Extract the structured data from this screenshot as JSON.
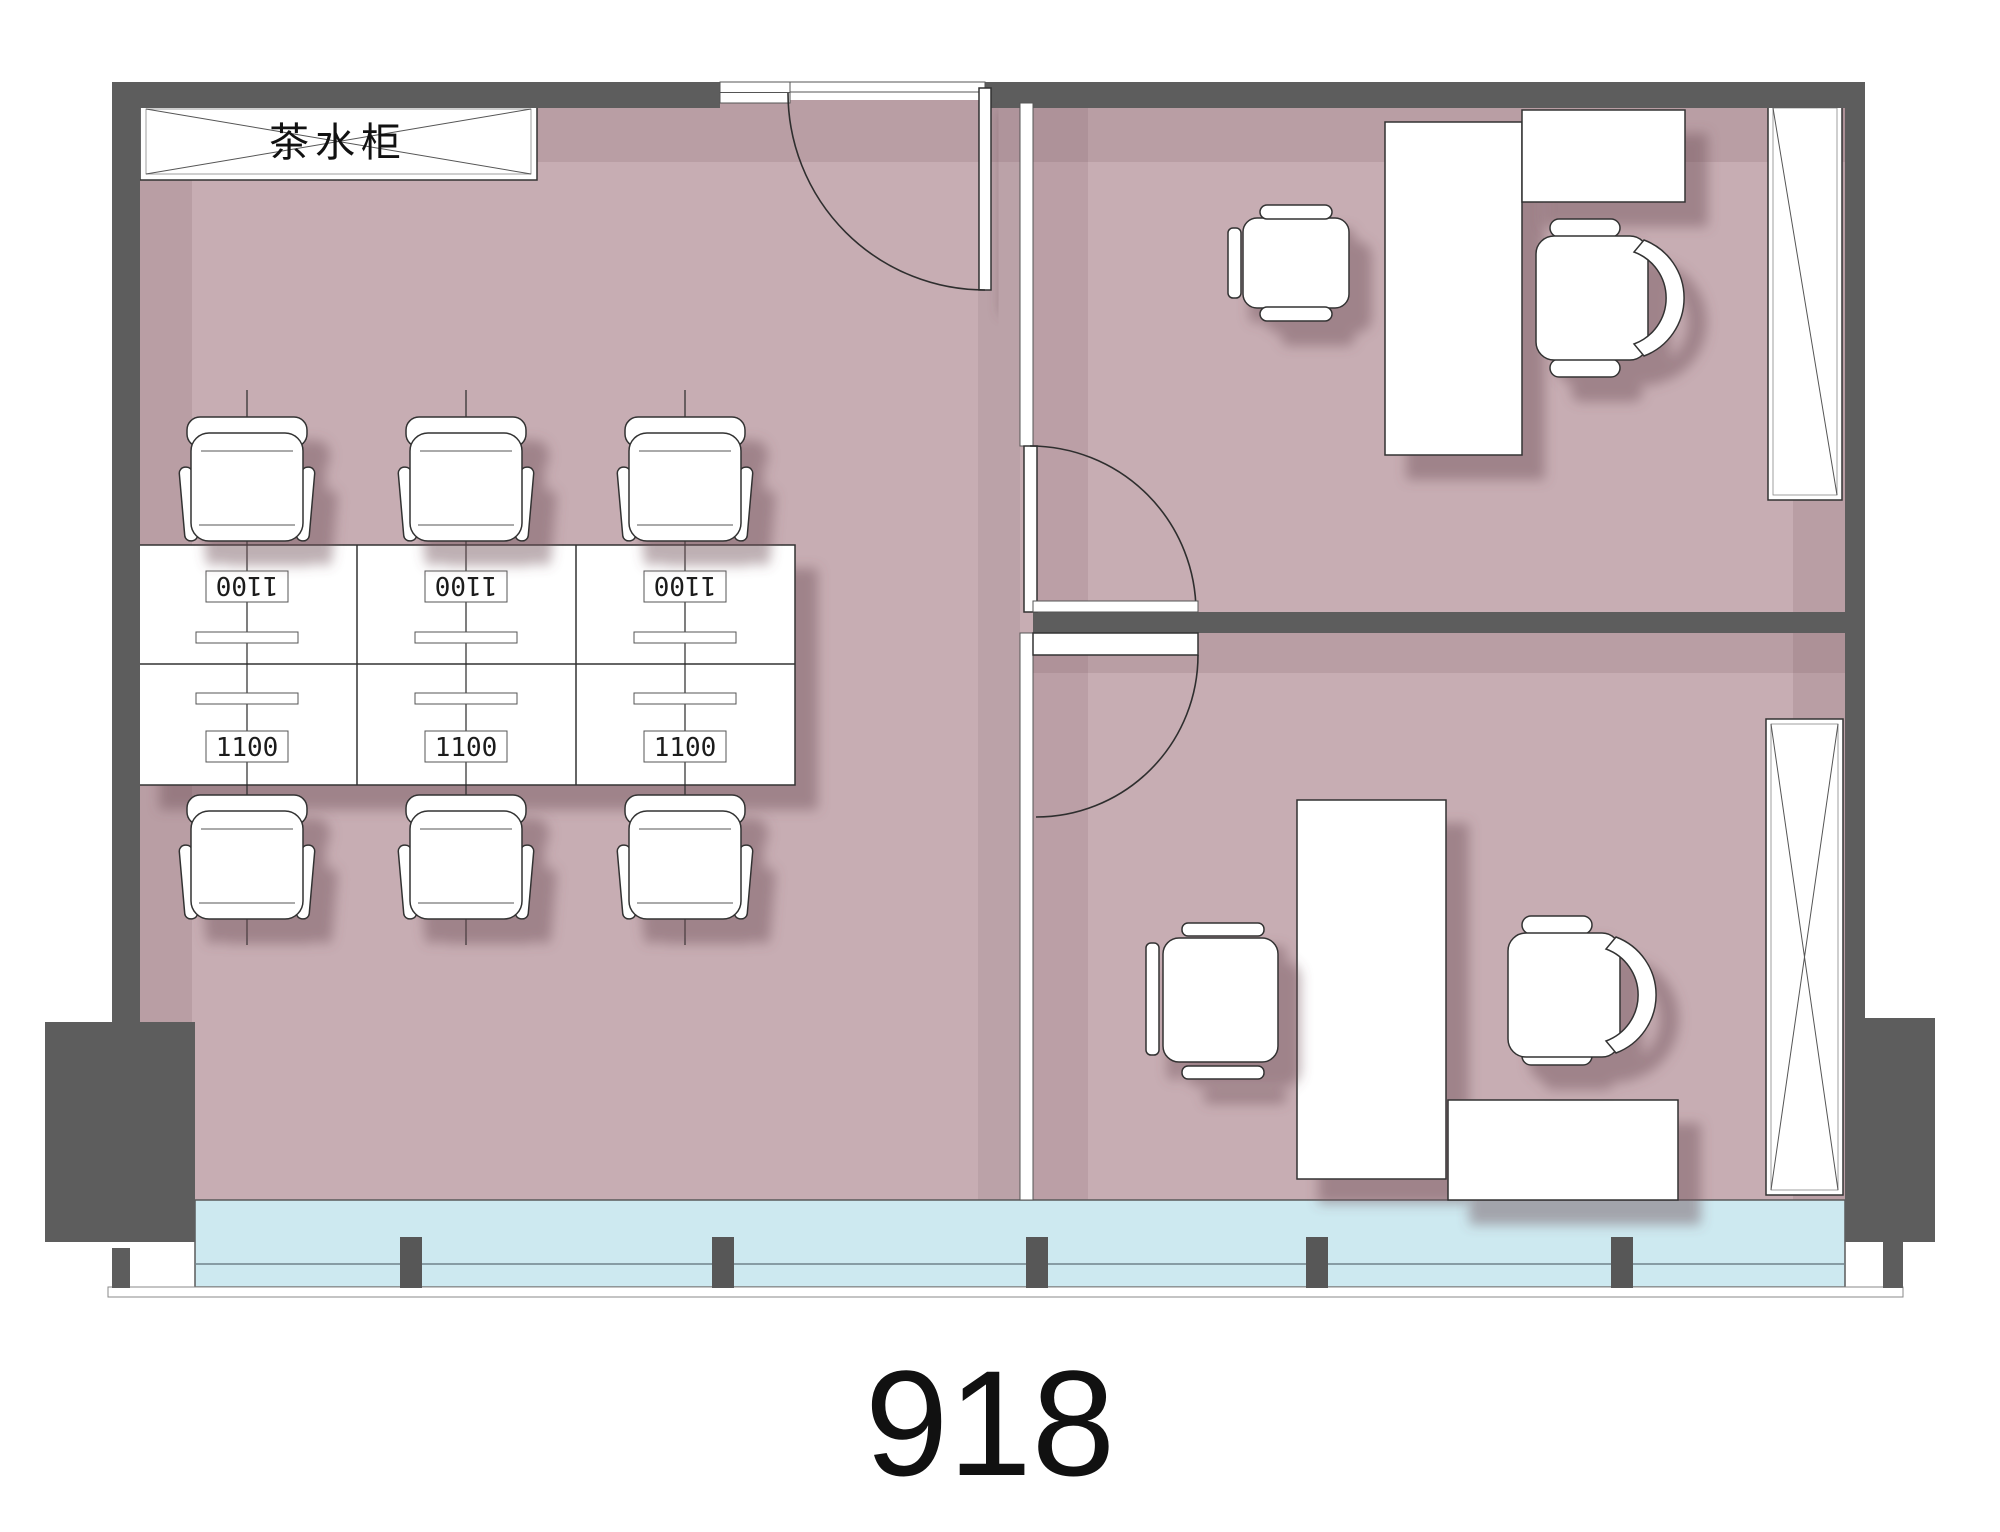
{
  "title": {
    "unit_number": "918"
  },
  "annotations": {
    "tea_cabinet_label": "茶水柜",
    "workstation_top_labels": [
      "1100",
      "1100",
      "1100"
    ],
    "workstation_bottom_labels": [
      "1100",
      "1100",
      "1100"
    ]
  },
  "colors": {
    "wall": "#5d5d5d",
    "floor": "#c7adb3",
    "glazing": "#cde9f0",
    "furniture": "#ffffff",
    "sill": "#ffffff",
    "text": "#111111"
  }
}
